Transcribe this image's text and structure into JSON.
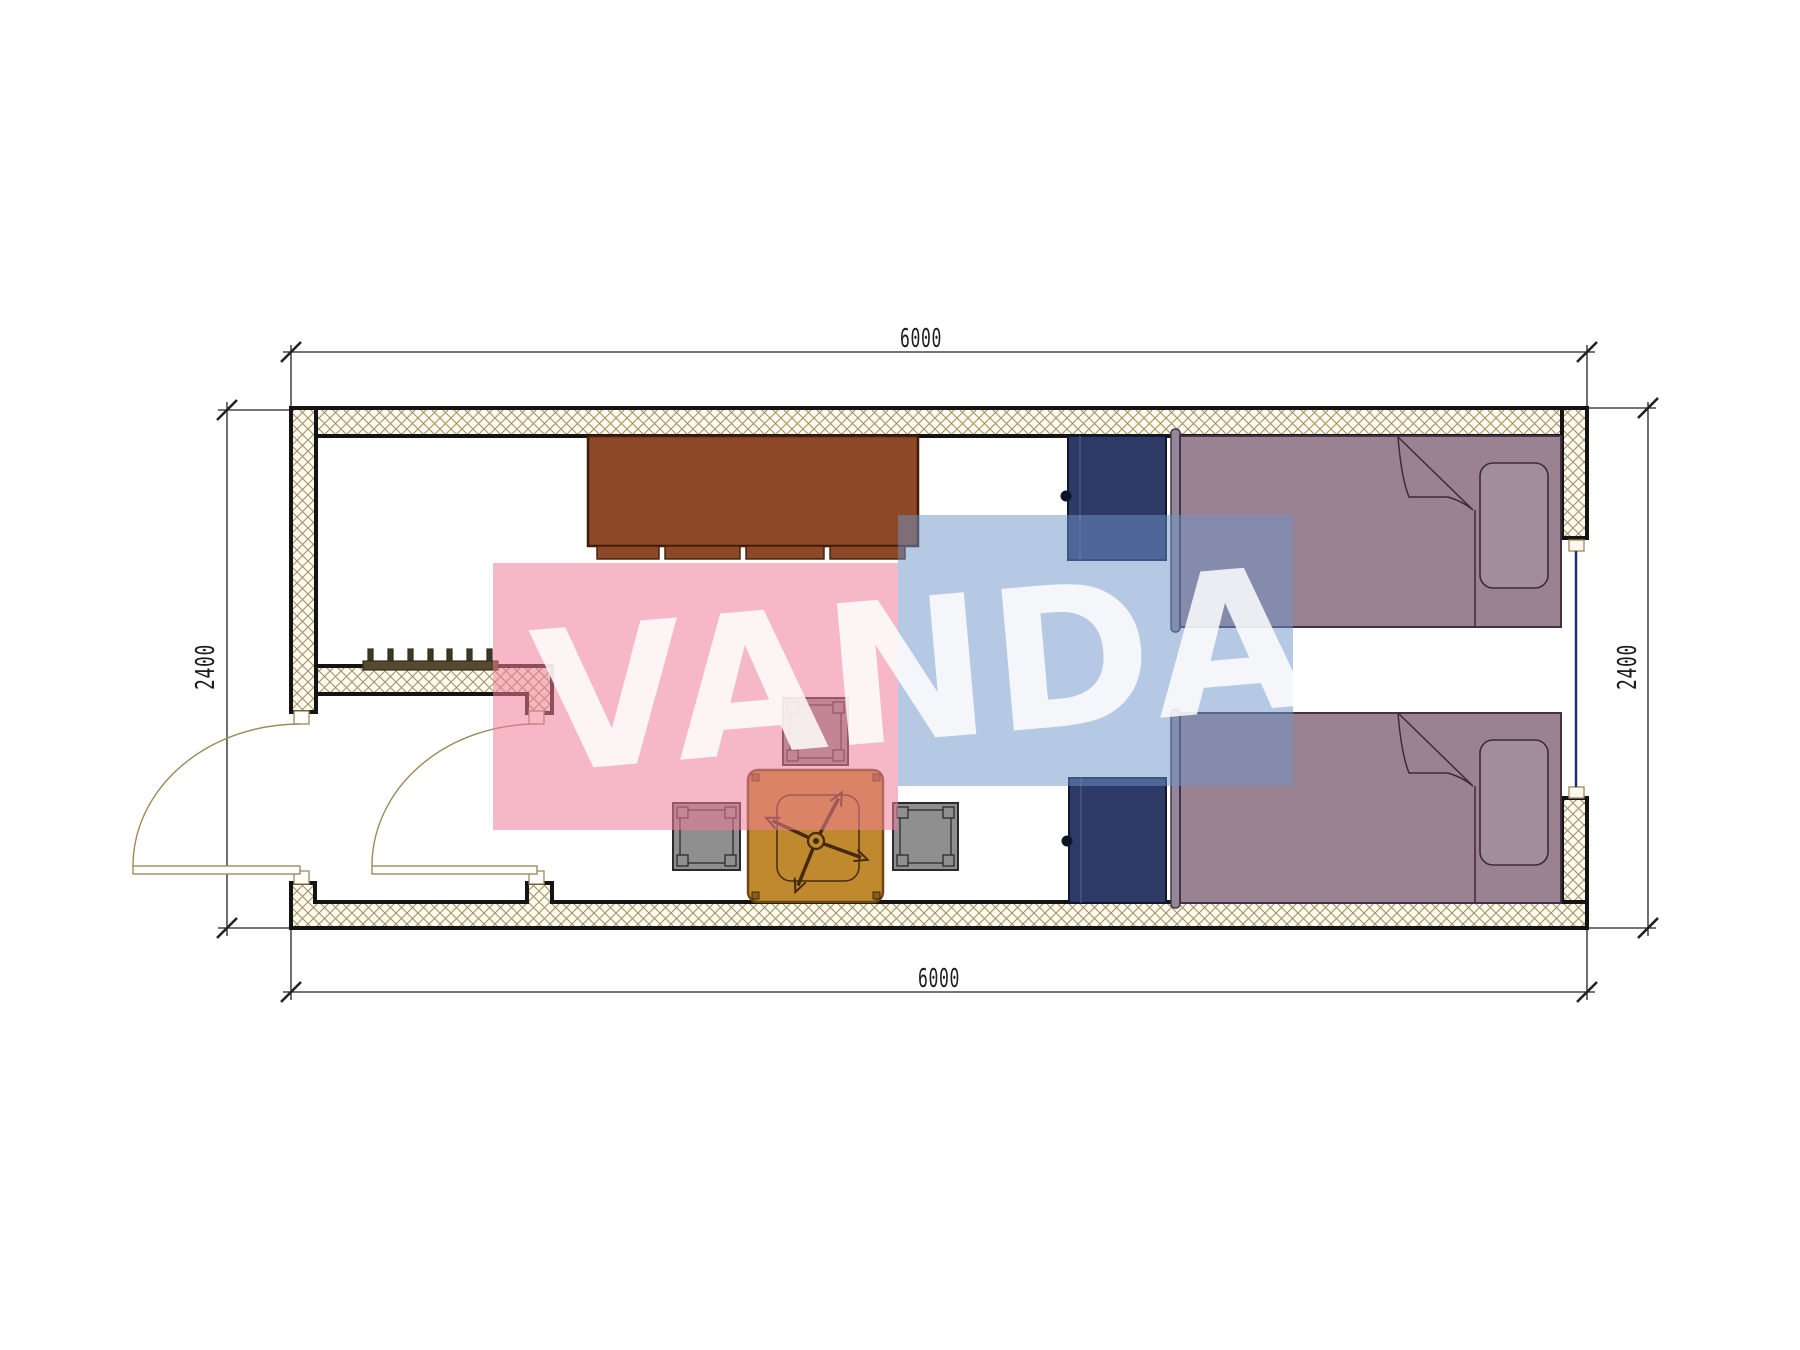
{
  "plan": {
    "title": "container-cabin-floor-plan",
    "dimensions": {
      "top_width": "6000",
      "bottom_width": "6000",
      "left_height": "2400",
      "right_height": "2400"
    },
    "watermark": {
      "text": "VANDA"
    },
    "palette": {
      "wall_hatch_line": "#a5925f",
      "wall_outline": "#141414",
      "dimension_line": "#222222",
      "door_line": "#9c8b5c",
      "window_glazing": "#1c2f6e",
      "desk": "#8d4827",
      "cabinet": "#2e3a66",
      "bed": "#9b8291",
      "pillow": "#a28d9b",
      "bed_line": "#3c2b3a",
      "table": "#c0892e",
      "table_detail": "#432a10",
      "stool": "#8f8f8f",
      "radiator": "#55492f",
      "watermark_pink": "#ee7d97",
      "watermark_blue": "#6d93c9",
      "watermark_text": "#ffffff"
    }
  }
}
